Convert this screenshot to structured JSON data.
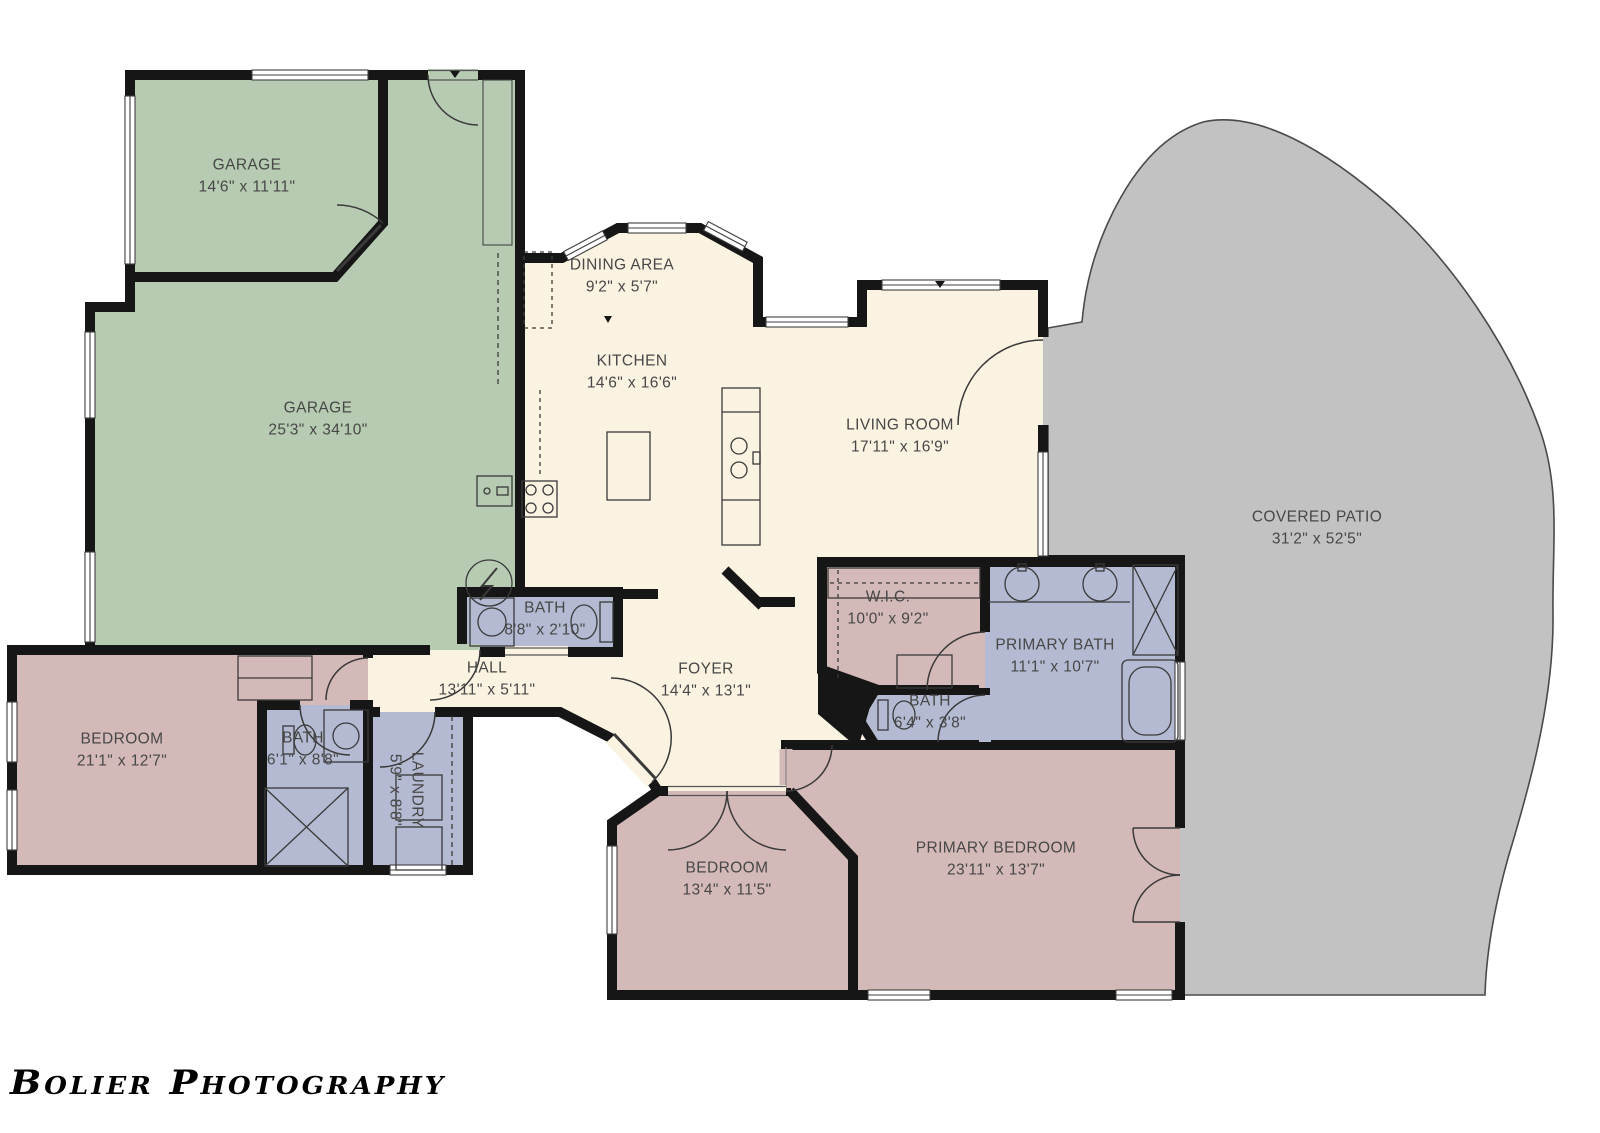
{
  "watermark": {
    "text": "Bolier Photography"
  },
  "palette": {
    "garage_green": "#b6cbb1",
    "interior_cream": "#faf3e1",
    "bedroom_pink": "#d3b9b8",
    "bath_lavender": "#b4bad2",
    "patio_gray": "#c2c2c2",
    "wall_black": "#161616",
    "label_gray": "#474747"
  },
  "rooms": [
    {
      "id": "garage-small",
      "name": "GARAGE",
      "dims": "14'6\" x 11'11\""
    },
    {
      "id": "garage",
      "name": "GARAGE",
      "dims": "25'3\" x 34'10\""
    },
    {
      "id": "dining-area",
      "name": "DINING AREA",
      "dims": "9'2\" x 5'7\""
    },
    {
      "id": "kitchen",
      "name": "KITCHEN",
      "dims": "14'6\" x 16'6\""
    },
    {
      "id": "living-room",
      "name": "LIVING ROOM",
      "dims": "17'11\" x 16'9\""
    },
    {
      "id": "covered-patio",
      "name": "COVERED PATIO",
      "dims": "31'2\" x 52'5\""
    },
    {
      "id": "bath-hall",
      "name": "BATH",
      "dims": "8'8\" x 2'10\""
    },
    {
      "id": "hall",
      "name": "HALL",
      "dims": "13'11\" x 5'11\""
    },
    {
      "id": "foyer",
      "name": "FOYER",
      "dims": "14'4\" x 13'1\""
    },
    {
      "id": "wic",
      "name": "W.I.C.",
      "dims": "10'0\" x 9'2\""
    },
    {
      "id": "primary-bath",
      "name": "PRIMARY BATH",
      "dims": "11'1\" x 10'7\""
    },
    {
      "id": "bath-suite",
      "name": "BATH",
      "dims": "6'4\" x 3'8\""
    },
    {
      "id": "bedroom-left",
      "name": "BEDROOM",
      "dims": "21'1\" x 12'7\""
    },
    {
      "id": "bath-left",
      "name": "BATH",
      "dims": "6'1\" x 8'8\""
    },
    {
      "id": "laundry",
      "name": "LAUNDRY",
      "dims": "5'9\" x 8'8\""
    },
    {
      "id": "bedroom-rear",
      "name": "BEDROOM",
      "dims": "13'4\" x 11'5\""
    },
    {
      "id": "primary-bedroom",
      "name": "PRIMARY BEDROOM",
      "dims": "23'11\" x 13'7\""
    }
  ]
}
